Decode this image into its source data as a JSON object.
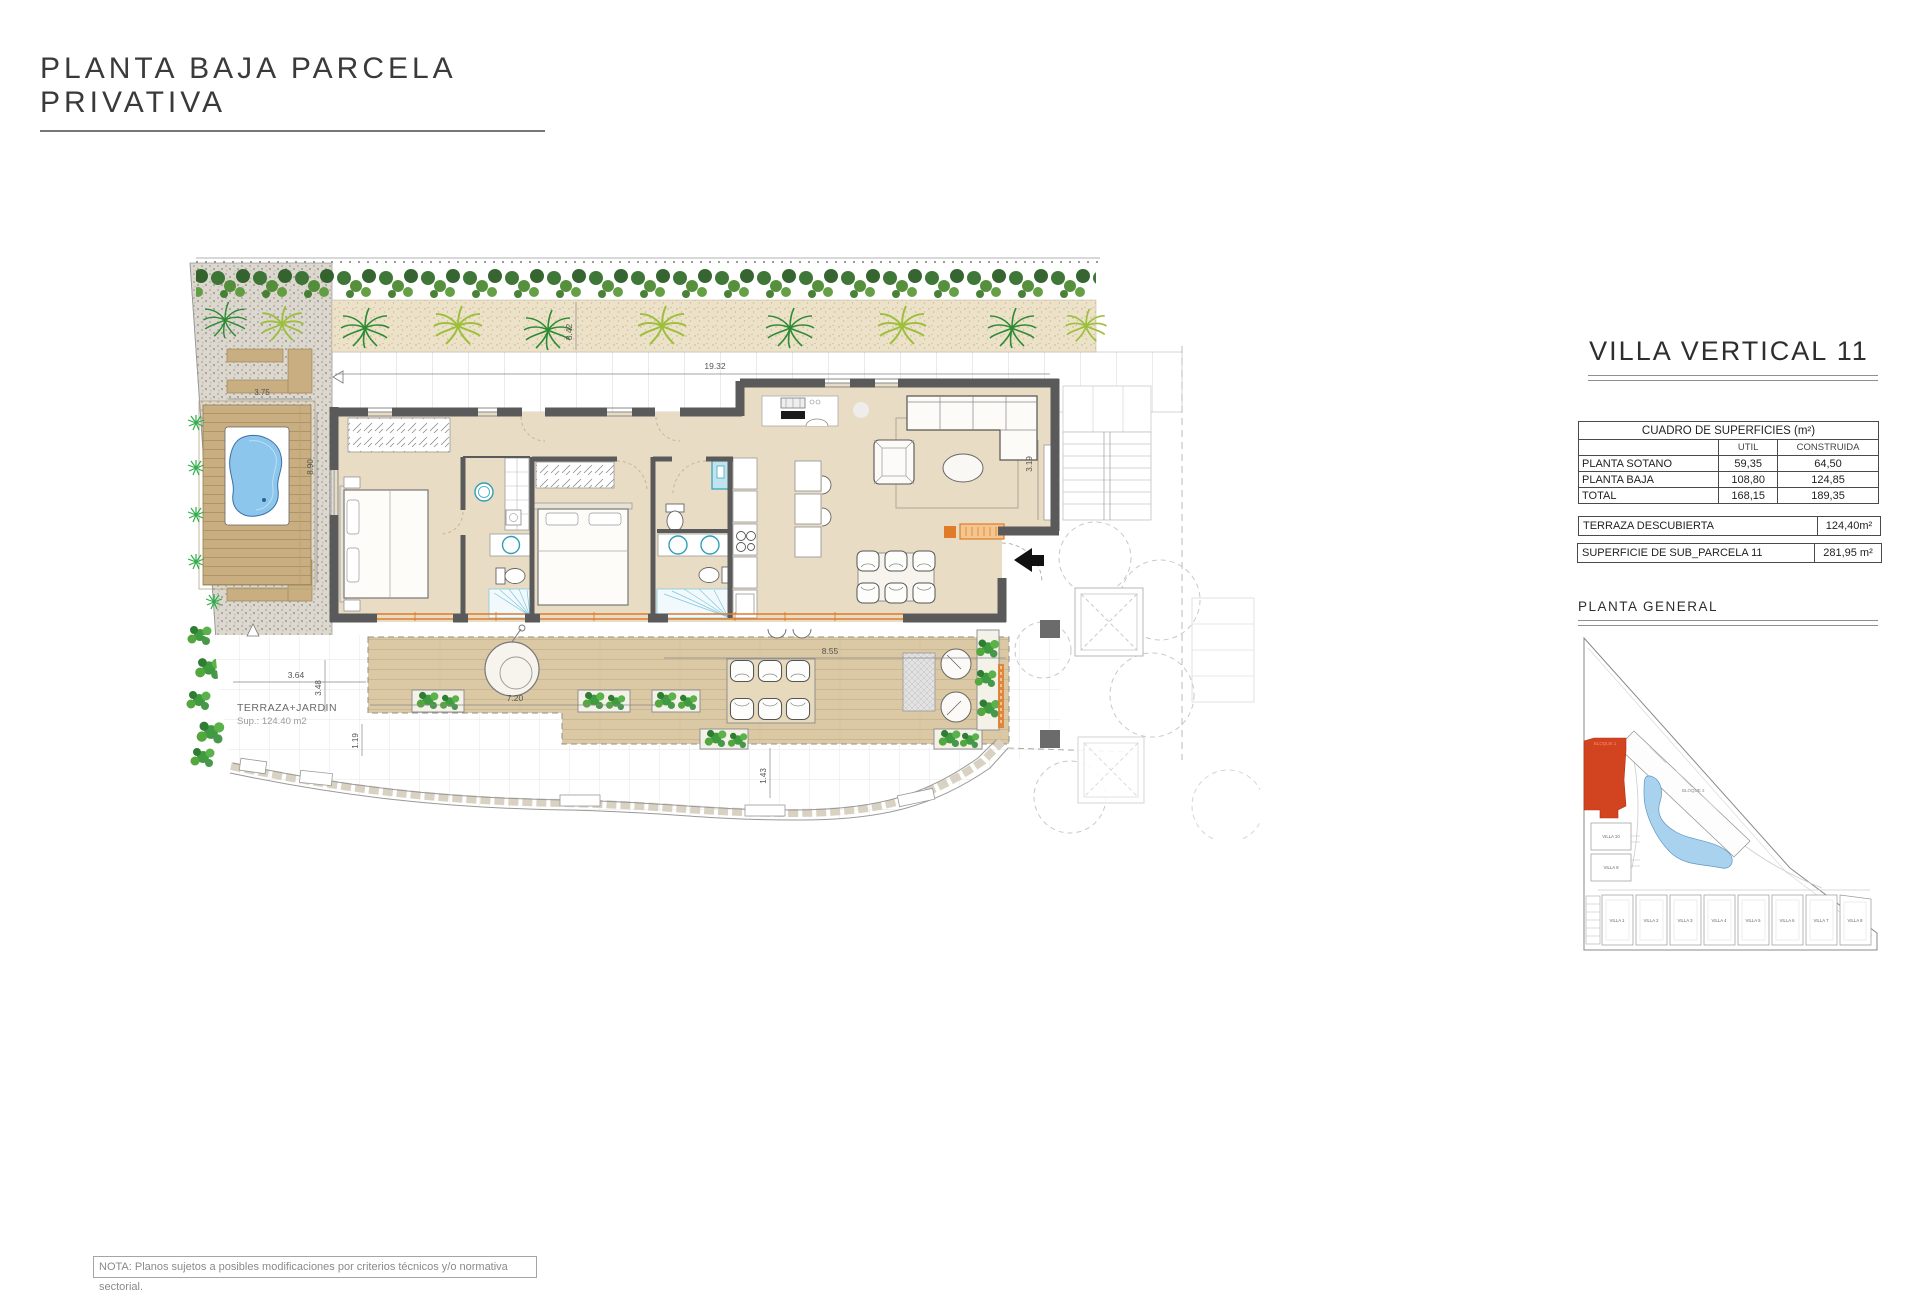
{
  "page": {
    "title": "PLANTA BAJA PARCELA PRIVATIVA",
    "note": "NOTA: Planos sujetos a posibles modificaciones por criterios técnicos y/o normativa sectorial."
  },
  "plan": {
    "terrace_label": "TERRAZA+JARDIN",
    "terrace_area": "Sup.: 124.40 m2",
    "dims": {
      "walkway": "19.32",
      "bed_side": "3.42",
      "deck_w": "3.75",
      "deck_h": "8.90",
      "terr_w1": "3.64",
      "terr_h1": "3.48",
      "terr_h2": "1.19",
      "terr_w2": "7.20",
      "terr_w3": "8.55",
      "terr_h3": "1.43",
      "living_h": "3.19"
    }
  },
  "panel": {
    "title": "VILLA VERTICAL 11",
    "table": {
      "title": "CUADRO DE SUPERFICIES (m²)",
      "col_util": "UTIL",
      "col_built": "CONSTRUIDA",
      "rows": [
        {
          "label": "PLANTA SOTANO",
          "util": "59,35",
          "built": "64,50"
        },
        {
          "label": "PLANTA BAJA",
          "util": "108,80",
          "built": "124,85"
        },
        {
          "label": "TOTAL",
          "util": "168,15",
          "built": "189,35"
        }
      ]
    },
    "terraza": {
      "label": "TERRAZA DESCUBIERTA",
      "value": "124,40m²"
    },
    "parcela": {
      "label": "SUPERFICIE DE SUB_PARCELA  11",
      "value": "281,95 m²"
    },
    "map_title": "PLANTA GENERAL",
    "map": {
      "bloque1": "BLOQUE 1",
      "bloque2": "BLOQUE 2",
      "villa10": "VILLA 10",
      "villa9": "VILLA 9",
      "villas": [
        "VILLA 1",
        "VILLA 2",
        "VILLA 3",
        "VILLA 4",
        "VILLA 5",
        "VILLA 6",
        "VILLA 7",
        "VILLA 8"
      ]
    }
  },
  "colors": {
    "accent_red": "#d2431f",
    "wall": "#5a5a5a",
    "floor": "#e9dcc4",
    "deck": "#dbc9a5",
    "wood": "#c9ae81",
    "pool": "#8cc6ec",
    "teal": "#2f9fb8",
    "orange": "#e07b28",
    "green_dark": "#2e7d32",
    "green_light": "#9cbf3e"
  }
}
